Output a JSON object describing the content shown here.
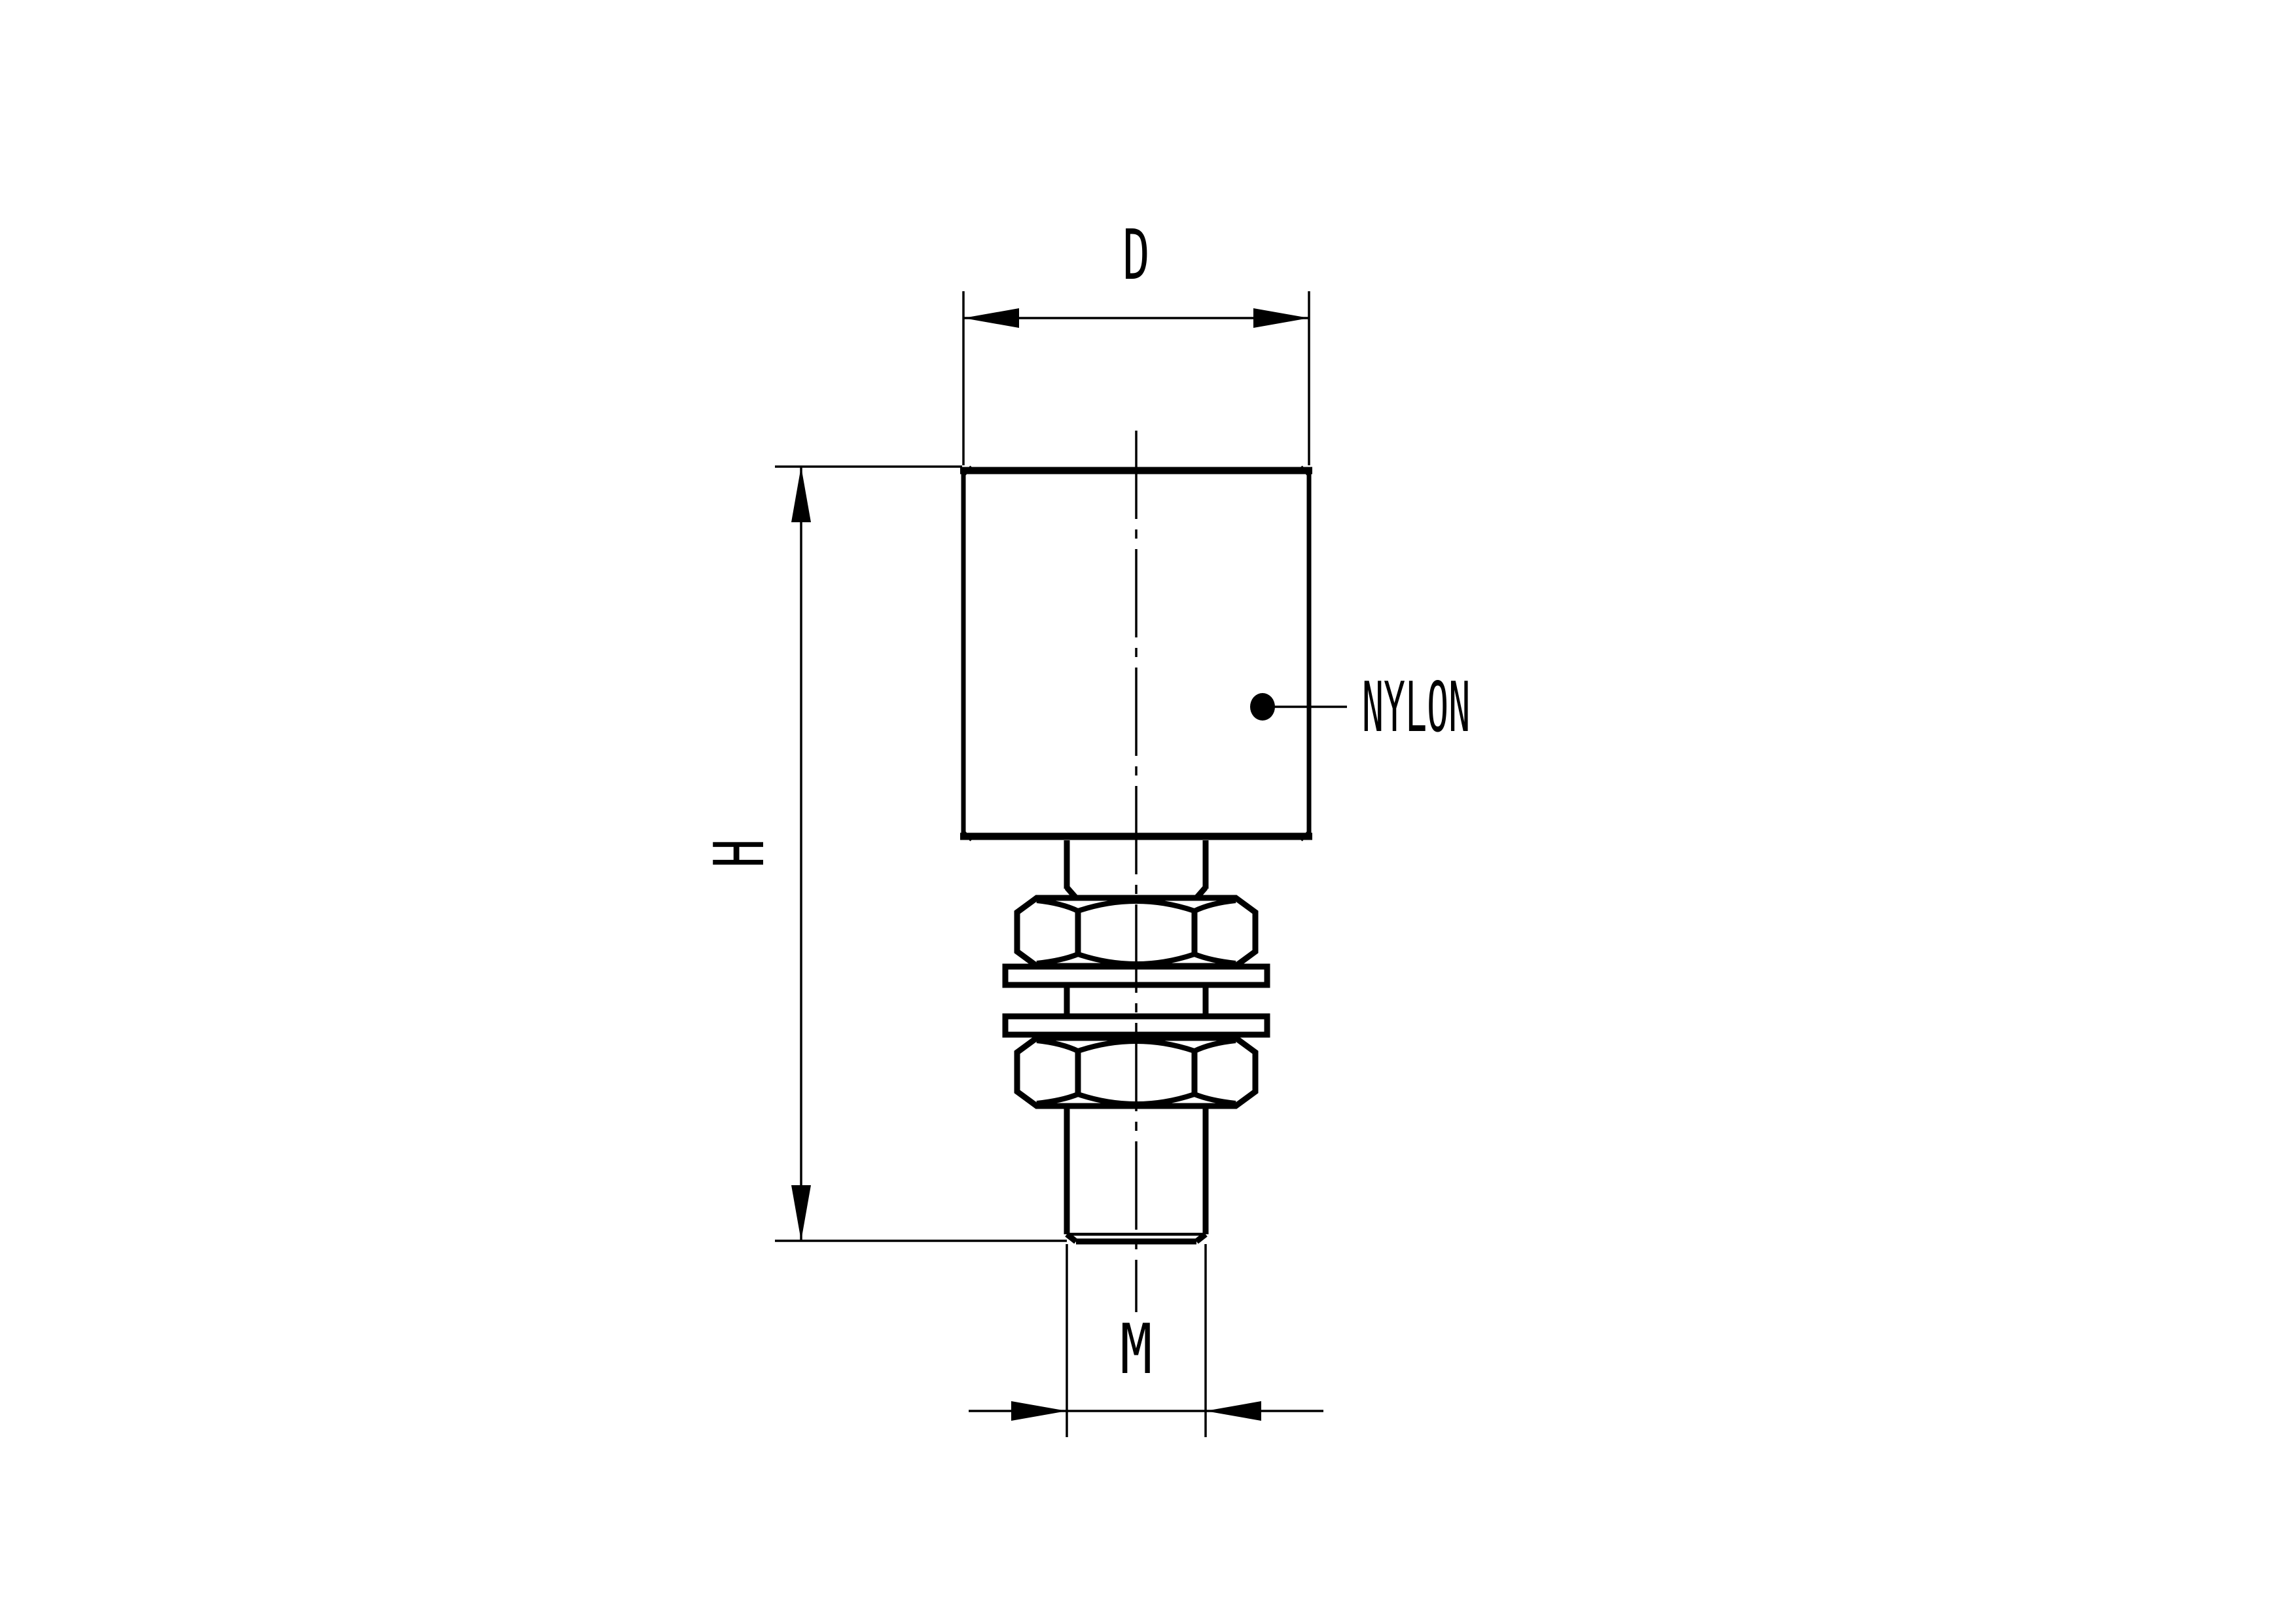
{
  "drawing": {
    "ink_color": "#000000",
    "paper_color": "#ffffff",
    "dimension_labels": {
      "diameter": "D",
      "height": "H",
      "thread": "M"
    },
    "callout": {
      "material": "NYLON"
    }
  }
}
